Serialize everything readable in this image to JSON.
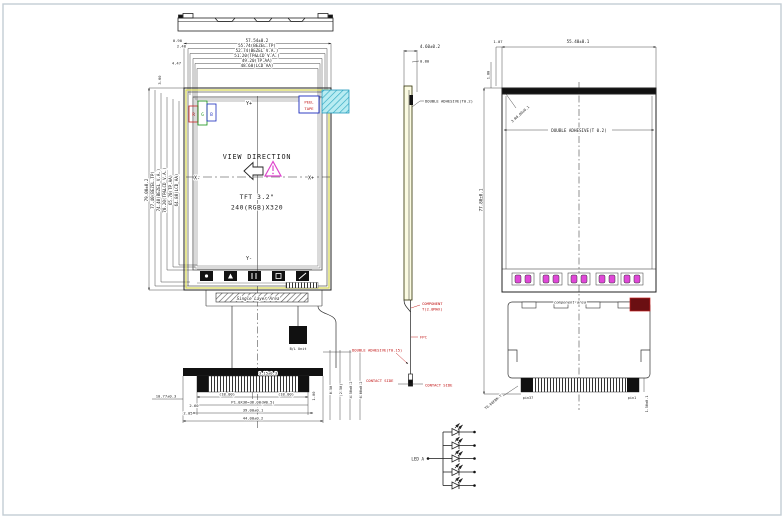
{
  "title": "TFT LCD module outline drawing",
  "colors": {
    "line": "#222222",
    "annotation_red": "#c01010",
    "peel_tape_cyan": "#b8ecf2",
    "polarizer_yellow": "#d8d85a",
    "component_magenta": "#e048d8",
    "label_blue": "#1a2bbd",
    "dark_component": "#6b0f12",
    "sheet_border": "#c3cdd4"
  },
  "front": {
    "top_dims": [
      "57.54±0.2",
      "55.74(BEZEL.TP)",
      "52.74(BEZEL V.A.)",
      "51.20(TP&LCD V.A.)",
      "49.20(TP.AA)",
      "48.60(LCD AA)"
    ],
    "left_dims": [
      "79.00±0.2",
      "77.40(BEZEL.TP)",
      "74.40(BEZEL V.A.)",
      "70.20(TP&LCD V.A.)",
      "65.70(TP.AA)",
      "64.80(LCD AA)"
    ],
    "offset_dims": [
      "0.90",
      "2.48",
      "4.47",
      "3.60"
    ],
    "axes": {
      "y_plus": "Y+",
      "y_minus": "Y-",
      "x_minus": "X-",
      "x_plus": "X+"
    },
    "rgb": [
      "R",
      "G",
      "B"
    ],
    "peel_tape": [
      "PEEL",
      "TAPE"
    ],
    "view_direction": "VIEW DIRECTION",
    "panel": [
      "TFT 3.2\"",
      "240(RGB)X320"
    ],
    "single_layer_area": "Single Layer Area",
    "backlight_unit": "B/L Unit",
    "connector": {
      "stiffener": "3.15±0.3",
      "half_left": "(18.00)",
      "half_right": "(18.00)",
      "pitch": "P1.0X36=36.00(W0.5)",
      "pins_width": "39.00±0.1",
      "total_width": "44.00±0.2",
      "left_offset": "10.77±0.3",
      "d1": "2.60",
      "d2": "2.05",
      "d3": "1.00",
      "right_stack": [
        "0.50",
        "(2.50)",
        "4.50±0.2",
        "6.00±0.2"
      ]
    }
  },
  "side": {
    "thickness": "4.60±0.2",
    "lcd_thickness": "0.80",
    "adhesive_top": "DOUBLE ADHESIVE(T0.2)",
    "component_line1": "COMPONENT",
    "component_line2": "T(2.0MAX)",
    "fpc": "FPC",
    "adhesive_bottom": "DOUBLE ADHESIVE(T0.15)",
    "contact_left": "CONTACT SIDE",
    "contact_right": "CONTACT SIDE"
  },
  "back": {
    "width": "55.40±0.1",
    "corner_offset": "1.07",
    "top_gap": "1.80",
    "height": "77.80±0.1",
    "corner_radius": "3-R0.80±0.1",
    "adhesive": "DOUBLE ADHESIVE(T 0.2)",
    "component_area": "component area",
    "pin_left": "pin37",
    "pin_right": "pin1",
    "connector_h": "1.50±0.1",
    "fpc_spec": "T0.08FBK-T"
  },
  "led": {
    "label": "LED A"
  }
}
